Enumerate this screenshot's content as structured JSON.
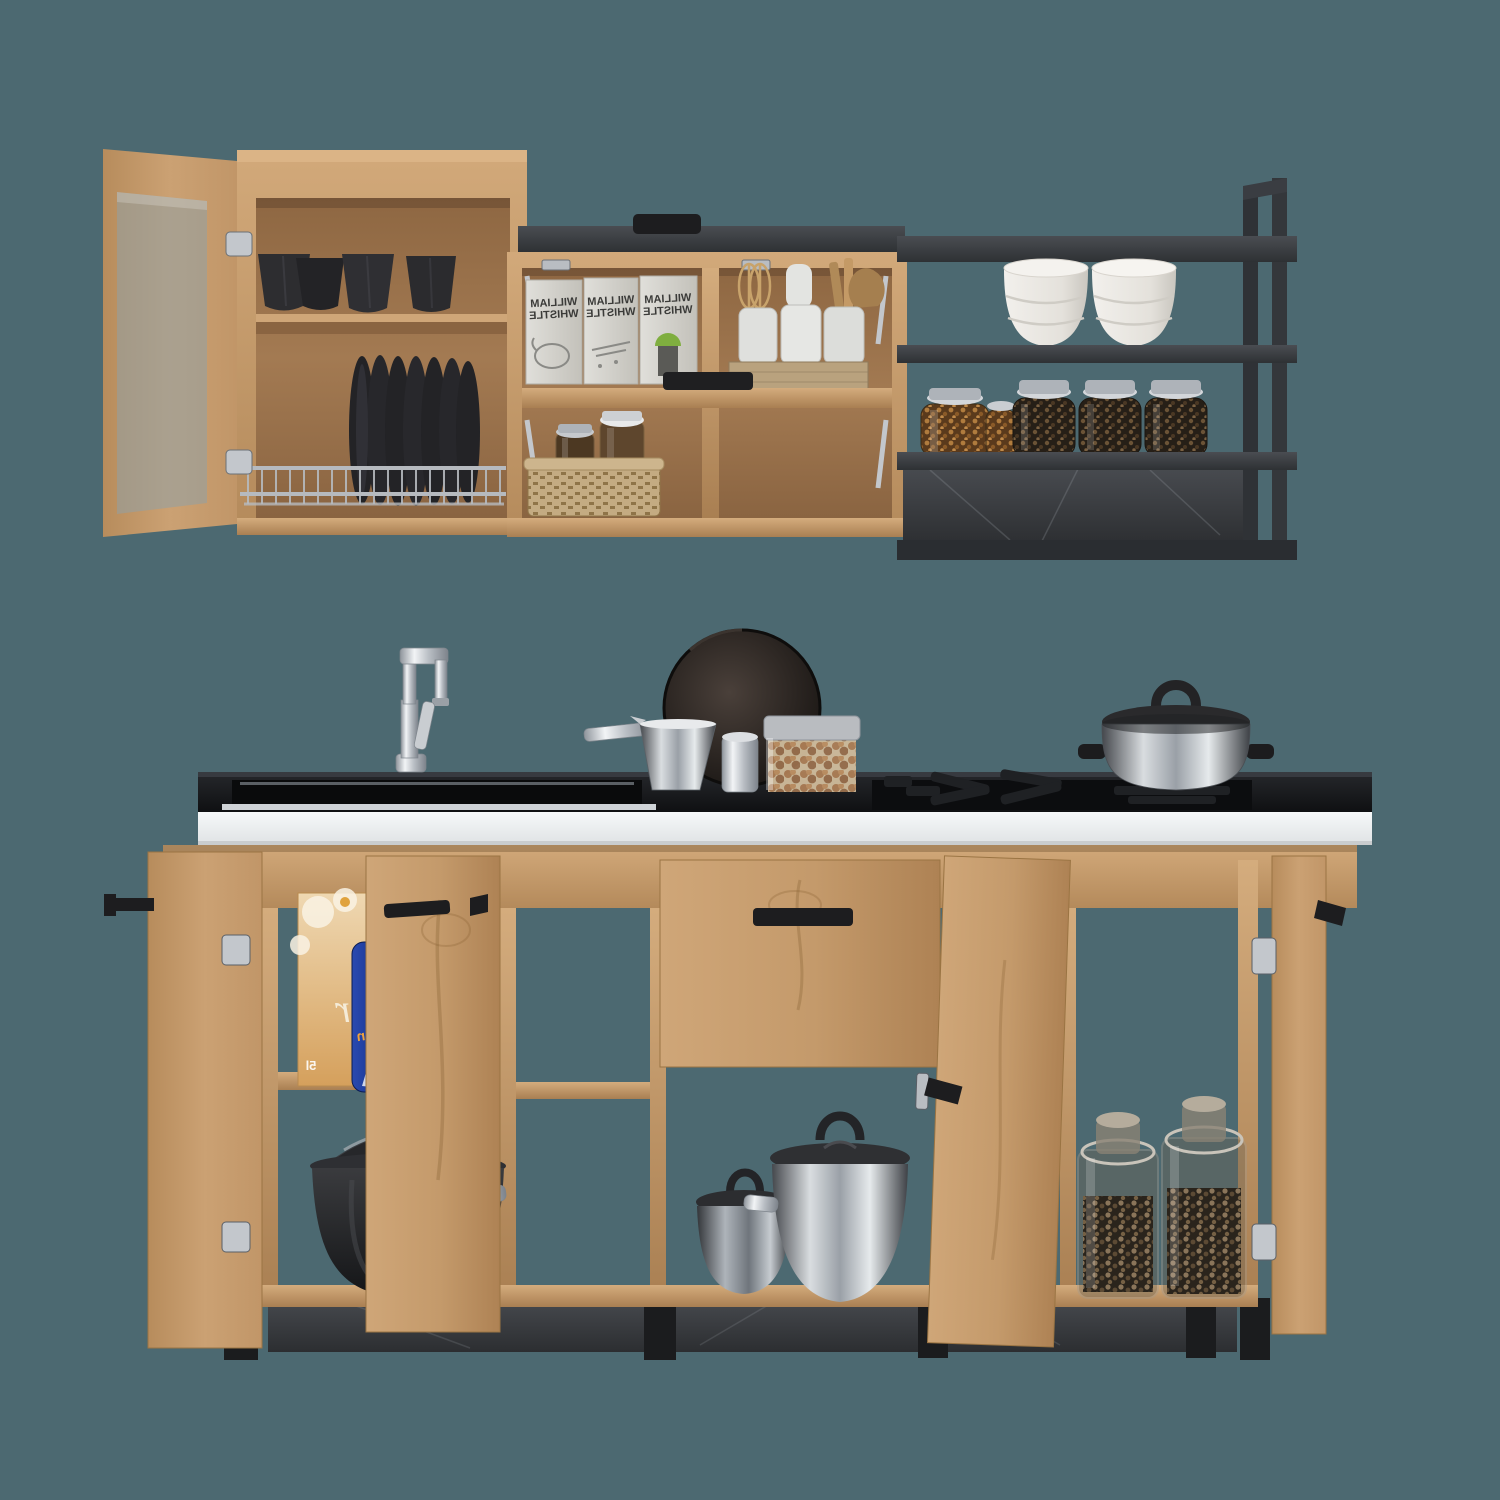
{
  "colors": {
    "background": "#4C6971",
    "wood_light": "#C9A272",
    "wood_mid": "#B98E5F",
    "wood_interior": "#9A744E",
    "metal_frame": "#33363A",
    "marble": "#3F4347",
    "counter_black": "#141518",
    "counter_band": "#EFF1F2",
    "steel": "#C9CDD1",
    "cardboard": "#D8D6D1",
    "lenor_beige": "#E5BE8E",
    "spray_blue": "#16338F",
    "amber_jar": "#7A4A20",
    "grain_dark": "#2F2820",
    "bowl_white": "#ECEAE5",
    "text_dark": "#3B3B39",
    "accent_orange": "#F0A23C"
  },
  "labels": {
    "cereal_brand_line1": "WILLIAM",
    "cereal_brand_line2": "WHISTLE",
    "detergent_brand": "Lenor",
    "detergent_size": "5l",
    "spray_brand": "Fusion"
  }
}
